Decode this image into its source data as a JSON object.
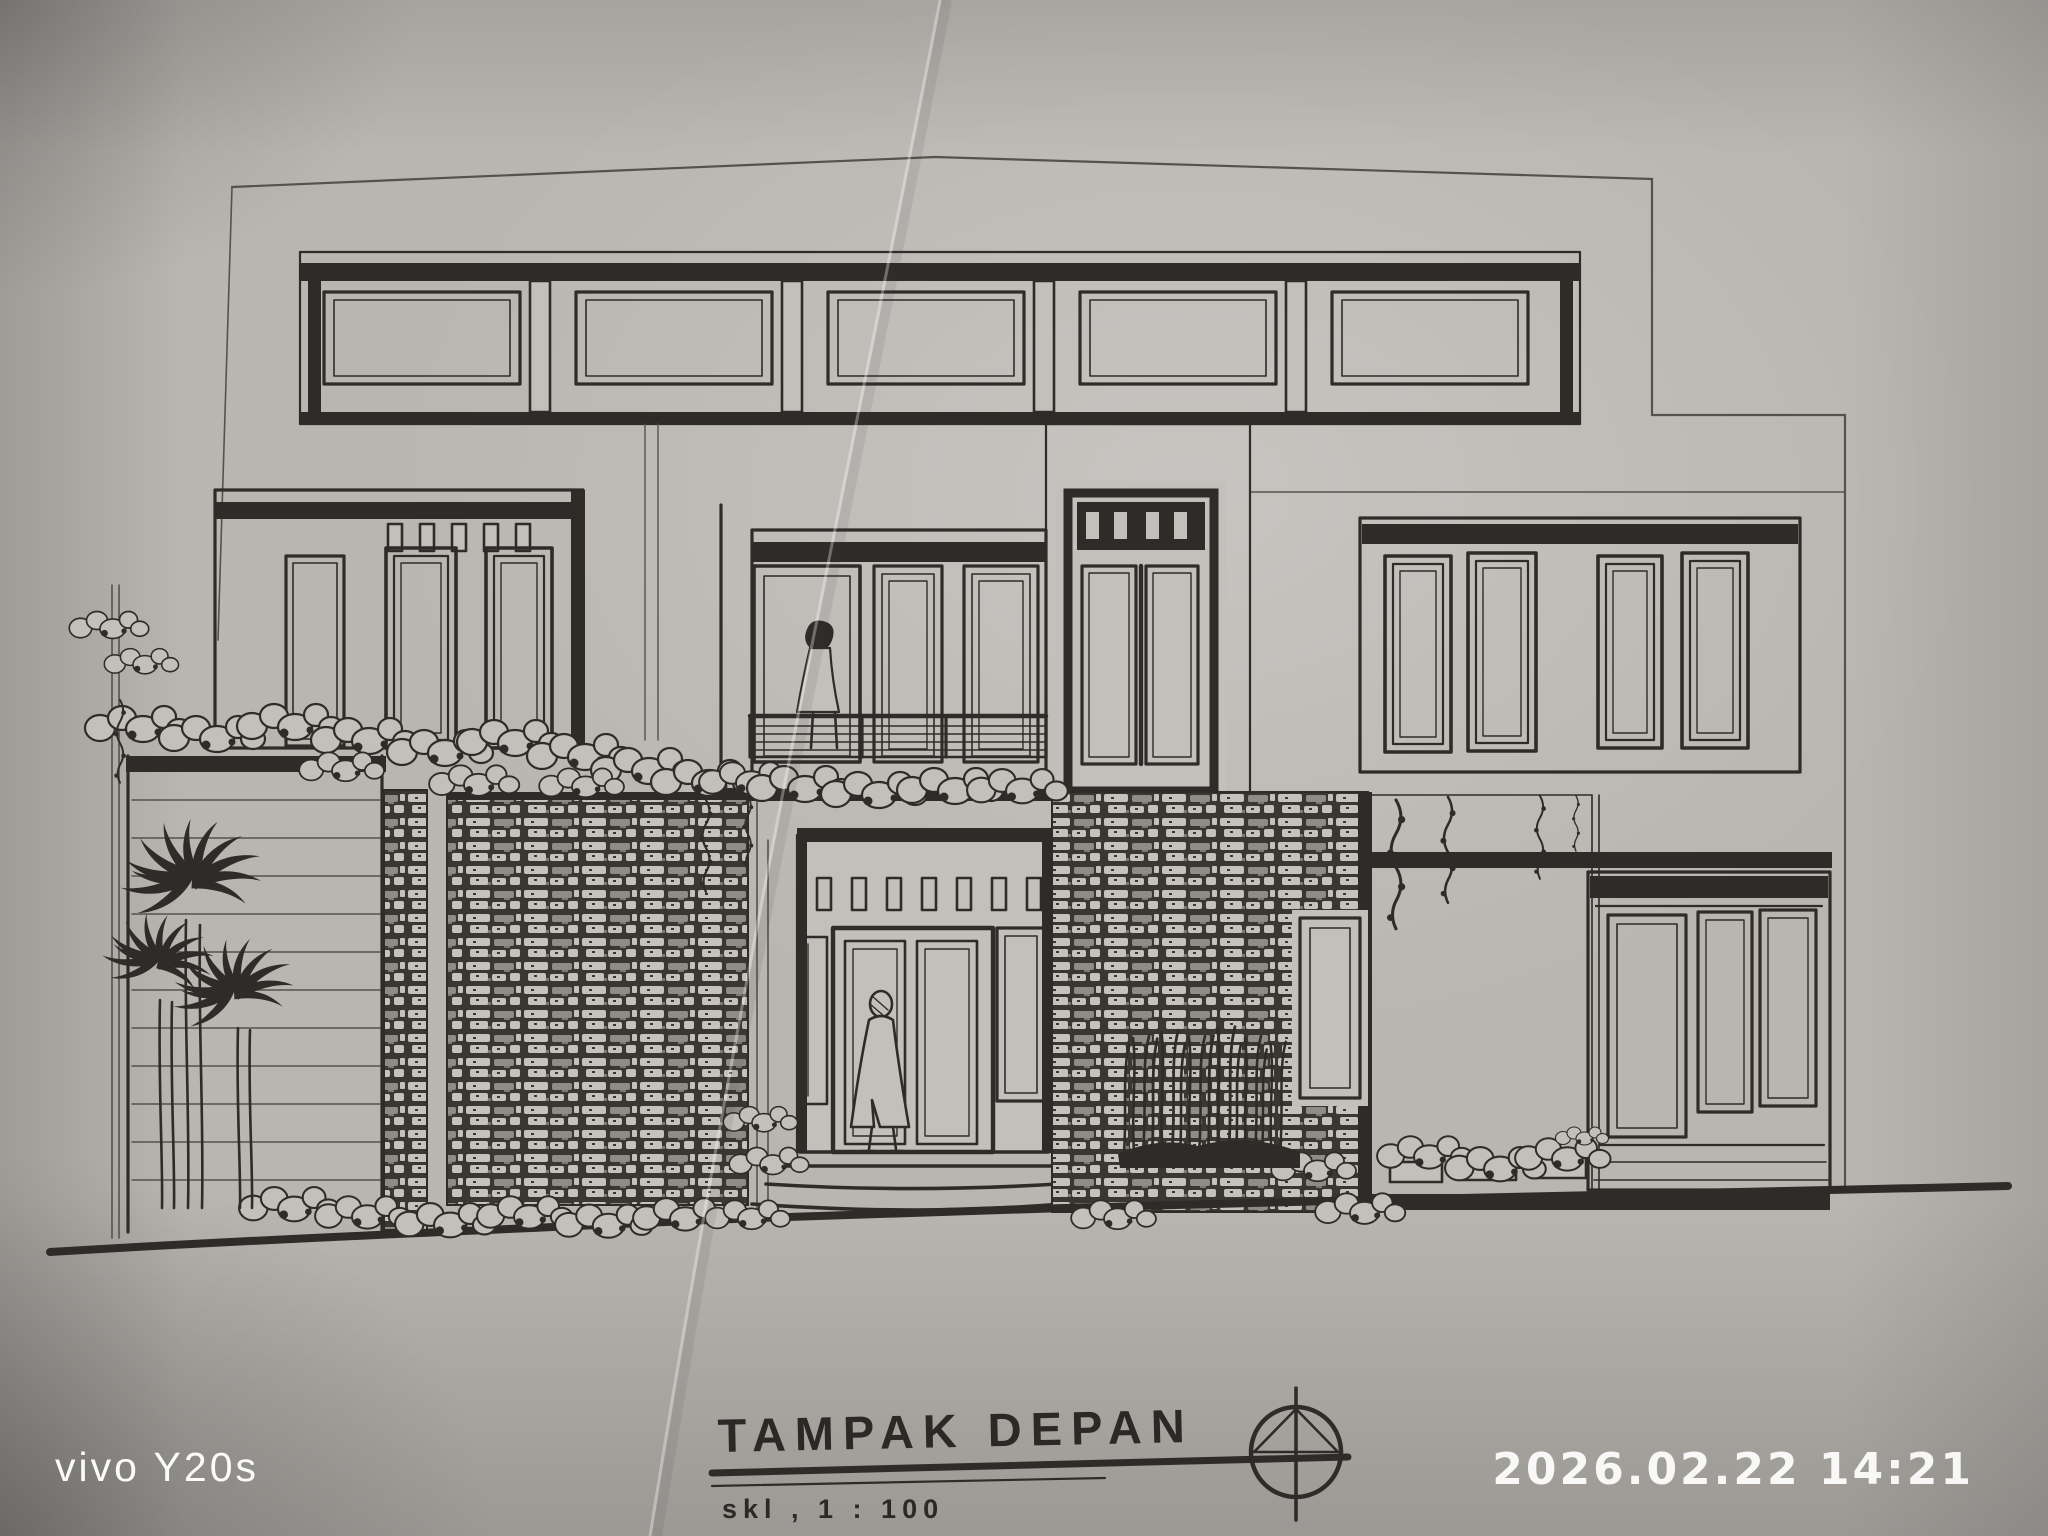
{
  "photo": {
    "device_watermark": "vivo Y20s",
    "timestamp": "2026.02.22 14:21"
  },
  "title_block": {
    "title": "TAMPAK DEPAN",
    "scale_label": "skl , 1 : 100",
    "north_symbol": "compass-circle-triangle-icon"
  },
  "colors": {
    "paper": "#b9b6b1",
    "ink": "#2e2c29",
    "watermark": "#ffffff"
  }
}
